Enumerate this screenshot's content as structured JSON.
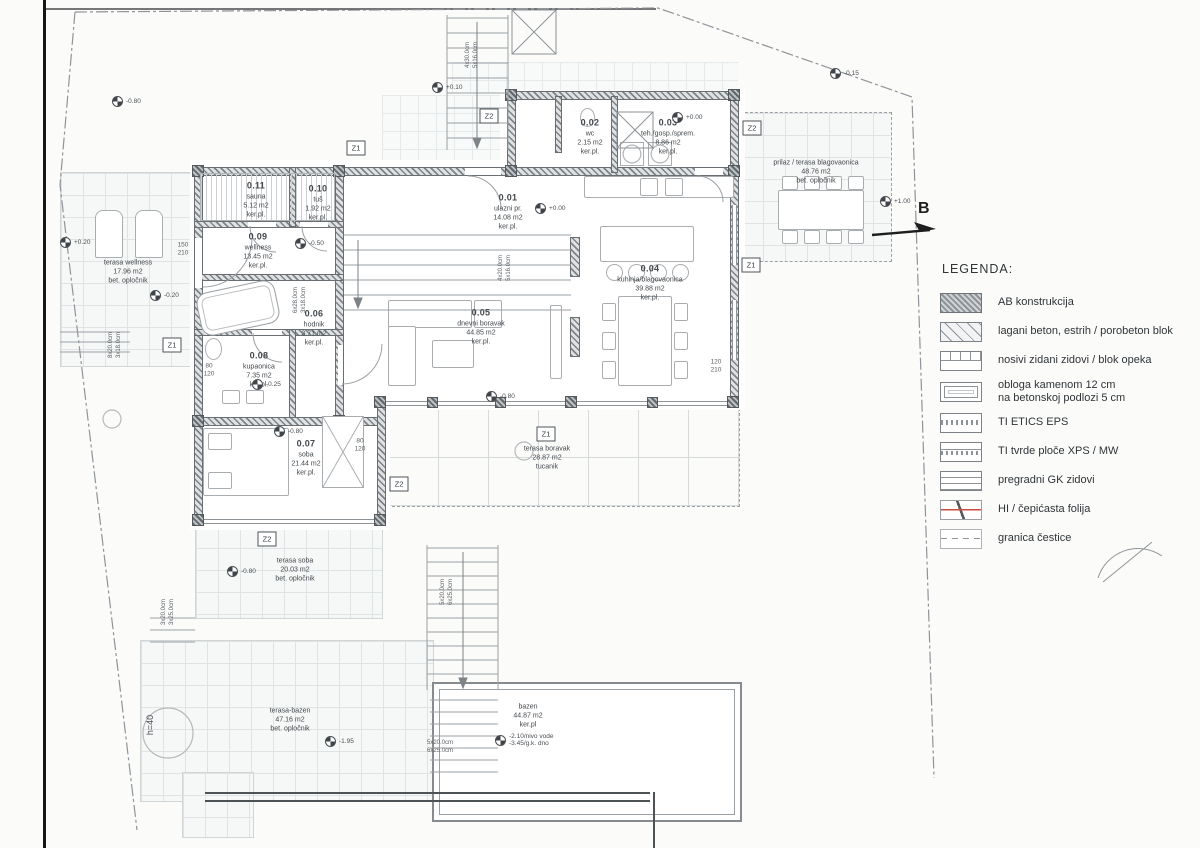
{
  "legend": {
    "title": "LEGENDA:",
    "items": [
      {
        "label": "AB konstrukcija",
        "label2": ""
      },
      {
        "label": "lagani beton, estrih / porobeton blok",
        "label2": ""
      },
      {
        "label": "nosivi zidani zidovi / blok opeka",
        "label2": ""
      },
      {
        "label": "obloga kamenom 12 cm",
        "label2": "na betonskoj podlozi 5 cm"
      },
      {
        "label": "TI ETICS EPS",
        "label2": ""
      },
      {
        "label": "TI tvrde ploče XPS / MW",
        "label2": ""
      },
      {
        "label": "pregradni GK zidovi",
        "label2": ""
      },
      {
        "label": "HI / čepićasta folija",
        "label2": ""
      },
      {
        "label": "granica čestice",
        "label2": ""
      }
    ]
  },
  "rooms": [
    {
      "id": "0.01",
      "name": "ulazni pr.",
      "area": "14.08 m2",
      "finish": "ker.pl."
    },
    {
      "id": "0.02",
      "name": "wc",
      "area": "2.15 m2",
      "finish": "ker.pl."
    },
    {
      "id": "0.03",
      "name": "teh./gosp./sprem.",
      "area": "8.86 m2",
      "finish": "ker.pl."
    },
    {
      "id": "0.04",
      "name": "kuhinja/blagovaonica",
      "area": "39.88 m2",
      "finish": "ker.pl."
    },
    {
      "id": "0.05",
      "name": "dnevni boravak",
      "area": "44.85 m2",
      "finish": "ker.pl."
    },
    {
      "id": "0.06",
      "name": "hodnik",
      "area": "3.71 m2",
      "finish": "ker.pl."
    },
    {
      "id": "0.07",
      "name": "soba",
      "area": "21.44 m2",
      "finish": "ker.pl."
    },
    {
      "id": "0.08",
      "name": "kupaonica",
      "area": "7.35 m2",
      "finish": "ker.pl."
    },
    {
      "id": "0.09",
      "name": "wellness",
      "area": "13.45 m2",
      "finish": "ker.pl."
    },
    {
      "id": "0.10",
      "name": "tuš",
      "area": "1.92 m2",
      "finish": "ker.pl."
    },
    {
      "id": "0.11",
      "name": "sauna",
      "area": "5.12 m2",
      "finish": "ker.pl."
    }
  ],
  "outdoor": [
    {
      "name": "terasa wellness",
      "area": "17.96 m2",
      "finish": "bet. opločnik"
    },
    {
      "name": "prilaz / terasa blagovaonica",
      "area": "48.76 m2",
      "finish": "bet. opločnik"
    },
    {
      "name": "terasa boravak",
      "area": "28.87 m2",
      "finish": "tucanik"
    },
    {
      "name": "terasa soba",
      "area": "20.03 m2",
      "finish": "bet. opločnik"
    },
    {
      "name": "terasa-bazen",
      "area": "47.16 m2",
      "finish": "bet. opločnik"
    },
    {
      "name": "bazen",
      "area": "44.87 m2",
      "finish": "ker.pl"
    }
  ],
  "levels": [
    "+0.00",
    "+0.00",
    "+0.10",
    "+0.20",
    "-0.15",
    "-0.80",
    "-0.50",
    "-0.25",
    "-0.80",
    "-0.80",
    "-0.80",
    "-1.95",
    "+1.00",
    "-0.20"
  ],
  "pool": {
    "line1": "-2.10/nivo vode",
    "line2": "-3.45/g.k. dno"
  },
  "stair_dims": [
    {
      "a": "4x30.0cm",
      "b": "5x16.0cm"
    },
    {
      "a": "4x20.0cm",
      "b": "5x16.0cm"
    },
    {
      "a": "6x28.0cm",
      "b": "3x18.0cm"
    },
    {
      "a": "5x20.0cm",
      "b": "6x25.0cm"
    },
    {
      "a": "5x20.0cm",
      "b": "6x25.0cm"
    },
    {
      "a": "8x20.0cm",
      "b": "3x18.0cm"
    },
    {
      "a": "3x20.0cm",
      "b": "3x25.0cm"
    }
  ],
  "door_dims": [
    {
      "a": "150",
      "b": "210"
    },
    {
      "a": "80",
      "b": "120"
    },
    {
      "a": "120",
      "b": "210"
    },
    {
      "a": "80",
      "b": "120"
    }
  ],
  "markers": [
    "Z1",
    "Z2",
    "Z2",
    "Z1",
    "Z1",
    "Z1",
    "Z2",
    "Z2"
  ],
  "misc": {
    "section_arrow": "B",
    "hedge": "h=40"
  }
}
